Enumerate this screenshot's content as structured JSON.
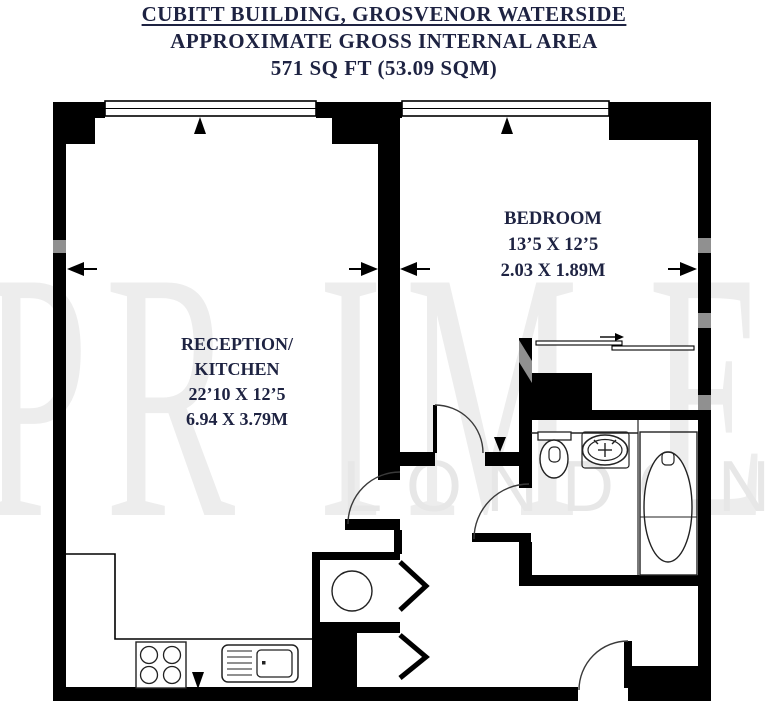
{
  "title": {
    "line1": "CUBITT BUILDING, GROSVENOR WATERSIDE",
    "line2": "APPROXIMATE GROSS INTERNAL AREA",
    "line3": "571 SQ FT (53.09 SQM)"
  },
  "rooms": {
    "reception": {
      "name_line1": "RECEPTION/",
      "name_line2": "KITCHEN",
      "dims_imperial": "22’10 X 12’5",
      "dims_metric": "6.94 X 3.79M"
    },
    "bedroom": {
      "name": "BEDROOM",
      "dims_imperial": "13’5 X 12’5",
      "dims_metric": "2.03 X 1.89M"
    }
  },
  "watermark": {
    "letters": [
      "P",
      "R",
      "I",
      "M",
      "E"
    ],
    "line2": "LONDON"
  },
  "colors": {
    "label_text": "#1e2342",
    "wall": "#000000",
    "watermark_large": "#ededed",
    "watermark_small": "#e7e7e7",
    "notch_gray": "#909090"
  }
}
